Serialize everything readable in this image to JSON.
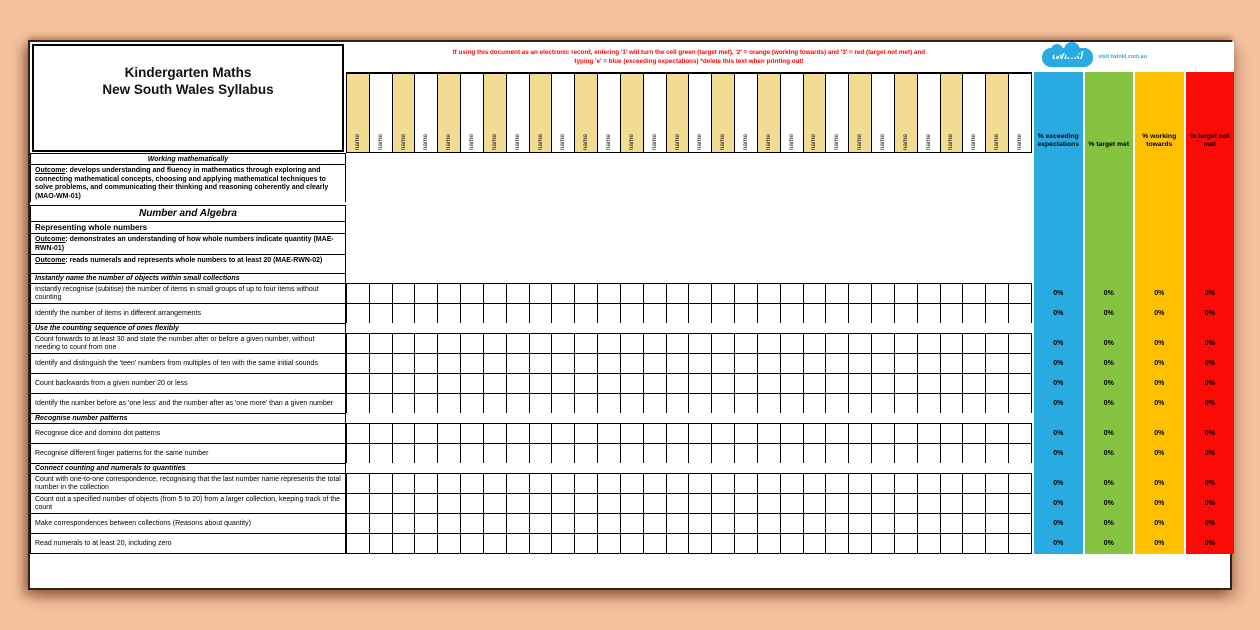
{
  "page": {
    "background_color": "#f4c19d"
  },
  "sheet": {
    "title": {
      "line1": "Kindergarten Maths",
      "line2": "New South Wales Syllabus"
    },
    "instruction": {
      "line1": "If using this document as an electronic record, entering '1' will turn the cell green (target met), '2' = orange (working towards) and '3' = red (target not met) and",
      "line2": "typing 'e' = blue (exceeding expectations) *delete this text when printing out!",
      "text_color": "#ff0000"
    },
    "brand": {
      "logo_text": "twinkl",
      "tagline": "visit twinkl.com.au",
      "color": "#29abe2"
    }
  },
  "name_columns": {
    "count": 30,
    "label": "name",
    "tan_color": "#f2db92",
    "white_color": "#ffffff"
  },
  "percent_columns": [
    {
      "id": "exceeding-expectations",
      "label": "% exceeding expectations",
      "color": "#29abe2"
    },
    {
      "id": "target-met",
      "label": "% target met",
      "color": "#84c441"
    },
    {
      "id": "working-towards",
      "label": "% working towards",
      "color": "#ffc000"
    },
    {
      "id": "target-not-met",
      "label": "% target not met",
      "color": "#fa0b05"
    }
  ],
  "default_percent": "0%",
  "rows": [
    {
      "type": "section-center",
      "text": "Working mathematically"
    },
    {
      "type": "outcome",
      "lead": "Outcome",
      "text": ": develops understanding and fluency in mathematics through exploring and connecting mathematical concepts, choosing and applying mathematical techniques to solve problems, and communicating their thinking and reasoning coherently and clearly (MAO-WM-01)"
    },
    {
      "type": "spacer",
      "text": ""
    },
    {
      "type": "strand",
      "text": "Number and Algebra"
    },
    {
      "type": "subhead",
      "text": "Representing whole numbers"
    },
    {
      "type": "outcome",
      "lead": "Outcome",
      "text": ": demonstrates an understanding of how whole numbers indicate quantity (MAE-RWN-01)"
    },
    {
      "type": "outcome",
      "lead": "Outcome",
      "text": ": reads numerals and represents whole numbers to at least 20 (MAE-RWN-02)"
    },
    {
      "type": "section",
      "text": "Instantly name the number of objects within small collections"
    },
    {
      "type": "skill",
      "text": "Instantly recognise (subitise) the number of items in small groups of up to four items without counting"
    },
    {
      "type": "skill",
      "text": "Identify the number of items in different arrangements"
    },
    {
      "type": "section",
      "text": "Use the counting sequence of ones flexibly"
    },
    {
      "type": "skill",
      "text": "Count forwards to at least 30 and state the number after or before a given number, without needing to count from one"
    },
    {
      "type": "skill",
      "text": "Identify and distinguish the 'teen' numbers from multiples of ten with the same initial sounds"
    },
    {
      "type": "skill",
      "text": "Count backwards from a given number 20 or less"
    },
    {
      "type": "skill",
      "text": "Identify the number before as 'one less' and the number after as 'one more' than a given number"
    },
    {
      "type": "section",
      "text": "Recognise number patterns"
    },
    {
      "type": "skill",
      "text": "Recognise dice and domino dot patterns"
    },
    {
      "type": "skill",
      "text": "Recognise different finger patterns for the same number"
    },
    {
      "type": "section",
      "text": "Connect counting and numerals to quantities"
    },
    {
      "type": "skill",
      "text": "Count with one-to-one correspondence, recognising that the last number name represents the total number in the collection"
    },
    {
      "type": "skill",
      "text": "Count out a specified number of objects (from 5 to 20) from a larger collection, keeping track of the count"
    },
    {
      "type": "skill",
      "text": "Make correspondences between collections (Reasons about quantity)"
    },
    {
      "type": "skill",
      "text": "Read numerals to at least 20, including zero"
    }
  ]
}
